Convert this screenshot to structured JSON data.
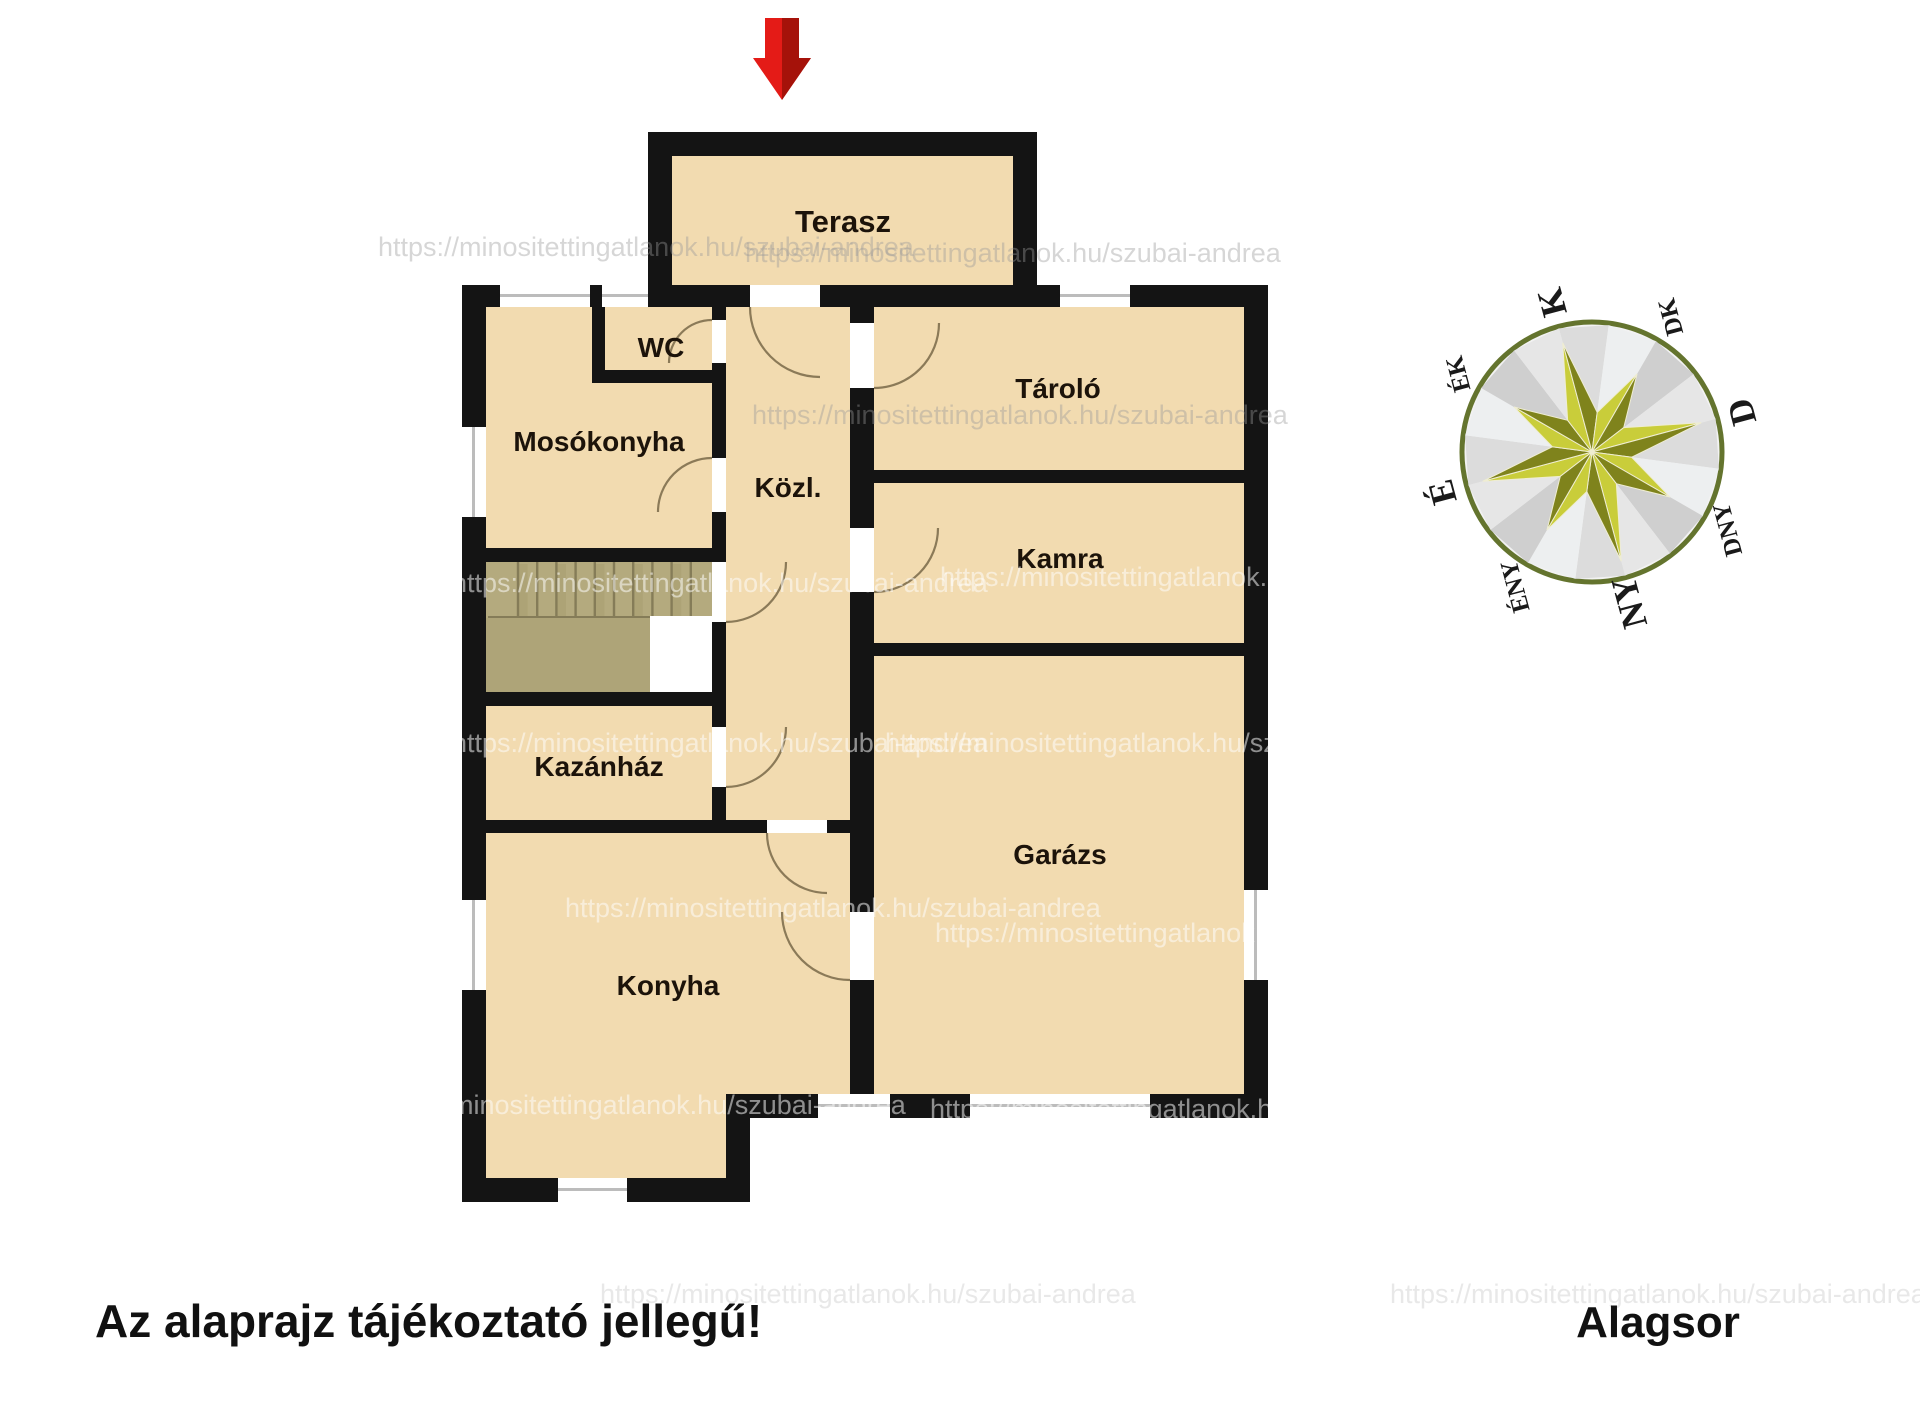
{
  "plan": {
    "rooms": {
      "terasz": "Terasz",
      "wc": "WC",
      "mosokonyha": "Mosókonyha",
      "kozl": "Közl.",
      "tarolo": "Tároló",
      "kamra": "Kamra",
      "kazanhaz": "Kazánház",
      "garazs": "Garázs",
      "konyha": "Konyha"
    }
  },
  "footer": {
    "disclaimer": "Az alaprajz tájékoztató jellegű!",
    "level": "Alagsor"
  },
  "compass": {
    "directions": {
      "n": "É",
      "ne": "ÉK",
      "e": "K",
      "se": "DK",
      "s": "D",
      "sw": "DNY",
      "w": "NY",
      "nw": "ÉNY"
    }
  },
  "watermark": {
    "text": "https://minositettingatlanok.hu/szubai-andrea"
  },
  "icons": {
    "entrance_arrow": "red-down-arrow",
    "compass_rose": "eight-point-star-compass"
  },
  "colors": {
    "room_fill": "#f2dbb0",
    "wall": "#141414",
    "stairs": "#b4aa7e",
    "arrow_red": "#e41b17",
    "arrow_red_dark": "#941007",
    "compass_star_light": "#c9cd3a",
    "compass_star_dark": "#7f831c",
    "compass_ring": "#64742e"
  }
}
